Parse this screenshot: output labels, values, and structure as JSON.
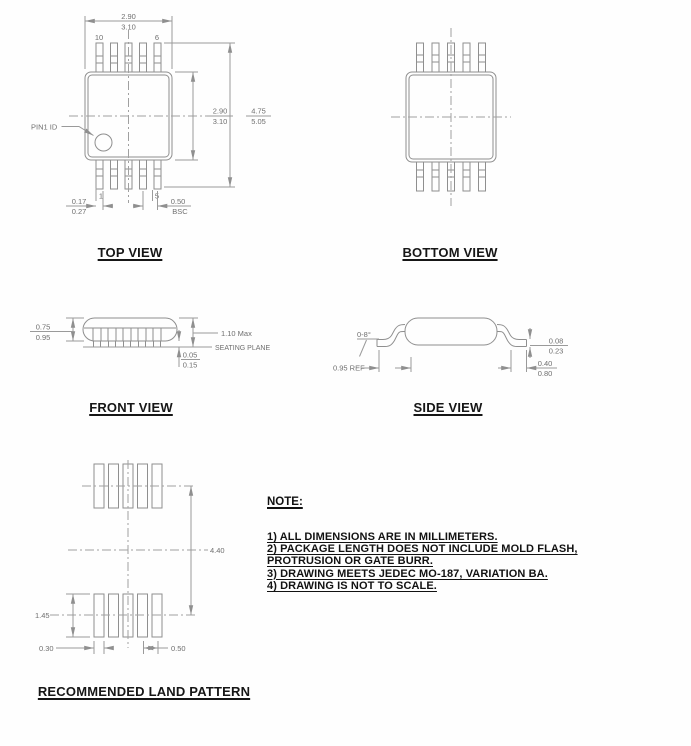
{
  "views": {
    "top_view": {
      "title": "TOP VIEW",
      "pin1_label": "PIN1 ID",
      "pin_numbers": {
        "top_left": "10",
        "top_right": "6",
        "bottom_left": "1",
        "bottom_right": "5"
      },
      "dim_width": {
        "upper": "2.90",
        "lower": "3.10"
      },
      "dim_body_length": {
        "upper": "2.90",
        "lower": "3.10"
      },
      "dim_overall_length": {
        "upper": "4.75",
        "lower": "5.05"
      },
      "dim_lead_width": {
        "upper": "0.17",
        "lower": "0.27"
      },
      "dim_pitch": {
        "upper": "0.50",
        "lower": "BSC"
      }
    },
    "bottom_view": {
      "title": "BOTTOM VIEW"
    },
    "front_view": {
      "title": "FRONT VIEW",
      "dim_body_thickness": {
        "upper": "0.75",
        "lower": "0.95"
      },
      "dim_height_max": "1.10 Max",
      "seating_plane_label": "SEATING PLANE",
      "dim_standoff": {
        "upper": "0.05",
        "lower": "0.15"
      }
    },
    "side_view": {
      "title": "SIDE VIEW",
      "dim_lead_angle": "0-8°",
      "dim_lead_ref": "0.95 REF",
      "dim_lead_thickness": {
        "upper": "0.08",
        "lower": "0.23"
      },
      "dim_foot_length": {
        "upper": "0.40",
        "lower": "0.80"
      }
    },
    "land_pattern": {
      "title": "RECOMMENDED LAND PATTERN",
      "dim_row_span": "4.40",
      "dim_pad_length": "1.45",
      "dim_pad_width": "0.30",
      "dim_pad_pitch": "0.50"
    }
  },
  "note": {
    "title": "NOTE:",
    "lines": [
      "1) ALL DIMENSIONS ARE IN MILLIMETERS.",
      "2) PACKAGE LENGTH DOES NOT INCLUDE MOLD FLASH,",
      "PROTRUSION OR GATE BURR.",
      "3) DRAWING MEETS JEDEC MO-187, VARIATION BA.",
      "4) DRAWING IS NOT TO SCALE."
    ]
  },
  "colors": {
    "line": "#8f8f8f",
    "dim_text": "#6f6f6f",
    "label_text": "#161616"
  }
}
